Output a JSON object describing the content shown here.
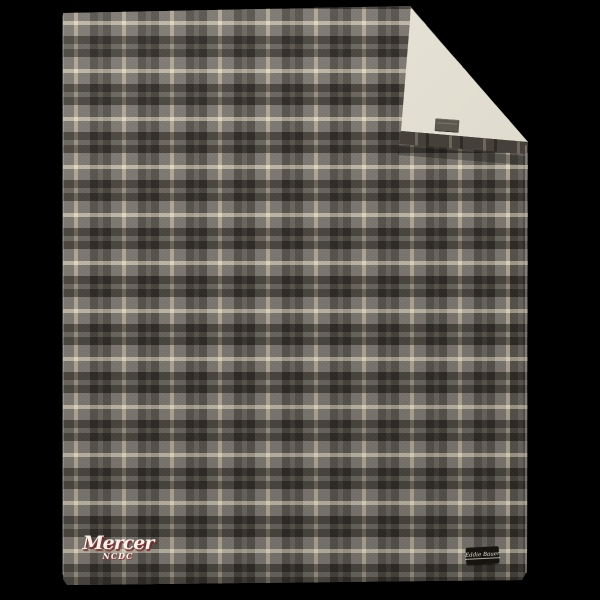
{
  "product": {
    "embroidery": {
      "line1": "Mercer",
      "line2": "NCDC",
      "thread_color": "#f6f3ea",
      "shadow_color": "#9b2e33"
    },
    "brand_tag": {
      "label": "Eddie Bauer",
      "bg_color": "#16140f",
      "text_color": "#ece8dc"
    },
    "colors": {
      "background": "#000000",
      "plaid_base_grey": "#7d7872",
      "plaid_dark_stripe": "#38342f",
      "plaid_mid_stripe": "#5d5852",
      "plaid_cream_stripe": "#d8d0b5",
      "sherpa_lining": "#e2ded1",
      "fold_hem": "#45403a",
      "fold_tag": "#5c584f"
    }
  }
}
